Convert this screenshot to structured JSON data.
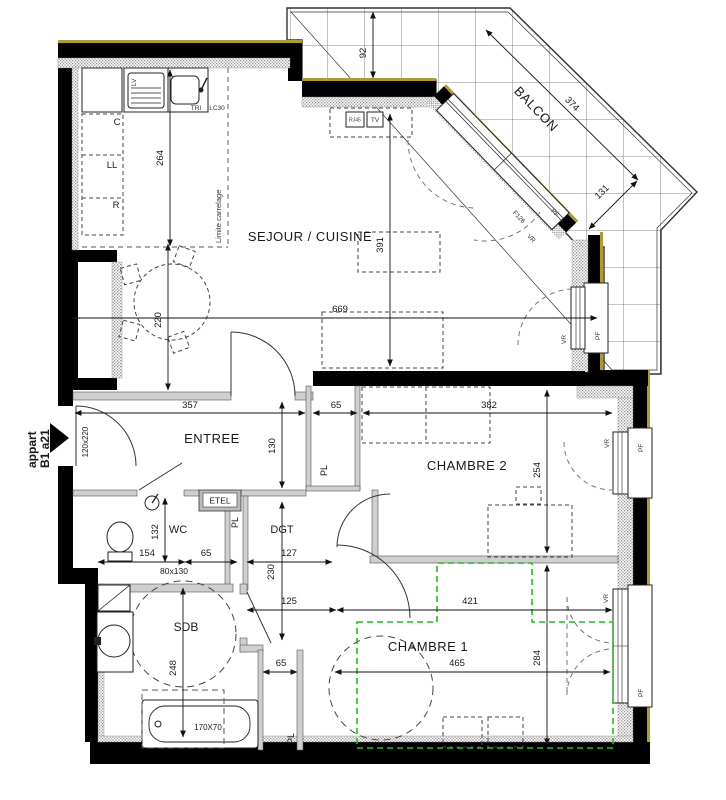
{
  "plan": {
    "apartment": {
      "line1": "appart",
      "line2": "B1 a21"
    },
    "rooms": {
      "balcon": "BALCON",
      "sejour": "SEJOUR / CUISINE",
      "entree": "ENTREE",
      "chambre2": "CHAMBRE 2",
      "wc": "WC",
      "dgt": "DGT",
      "sdb": "SDB",
      "chambre1": "CHAMBRE 1"
    },
    "annotations": {
      "limite_carrelage": "Limite carrelage",
      "etel": "ETEL",
      "pl": "PL",
      "lv": "LV",
      "tri": "TRI",
      "lc30": "LC30",
      "c": "C",
      "ll": "LL",
      "r": "R",
      "rj45": "RJ45",
      "tv": "TV",
      "pf": "PF",
      "vr": "VR",
      "f126": "F126"
    },
    "dimensions": {
      "balcony_depth": "92",
      "balcony_edge": "374",
      "balcony_corner": "131",
      "kitchen_depth": "264",
      "sejour_left": "220",
      "sejour_mid": "391",
      "sejour_width": "669",
      "entree_width": "357",
      "pl2_width": "65",
      "chambre2_width": "382",
      "entree_depth": "130",
      "chambre2_depth": "254",
      "wc_depth": "132",
      "wc_width": "154",
      "pl_entree_width": "65",
      "dgt_width": "127",
      "dgt_length": "230",
      "dgt_passage": "125",
      "sdb_depth": "248",
      "pl1_width": "65",
      "chambre1_inner": "421",
      "chambre1_width": "465",
      "chambre1_depth": "284",
      "entry_door": "120x220",
      "wc_size": "80x130",
      "bath_size": "170X70"
    },
    "colors": {
      "wall": "#000000",
      "facade_accent": "#b09c2a",
      "green_zone": "#19c119",
      "insulation": "#969696"
    }
  }
}
